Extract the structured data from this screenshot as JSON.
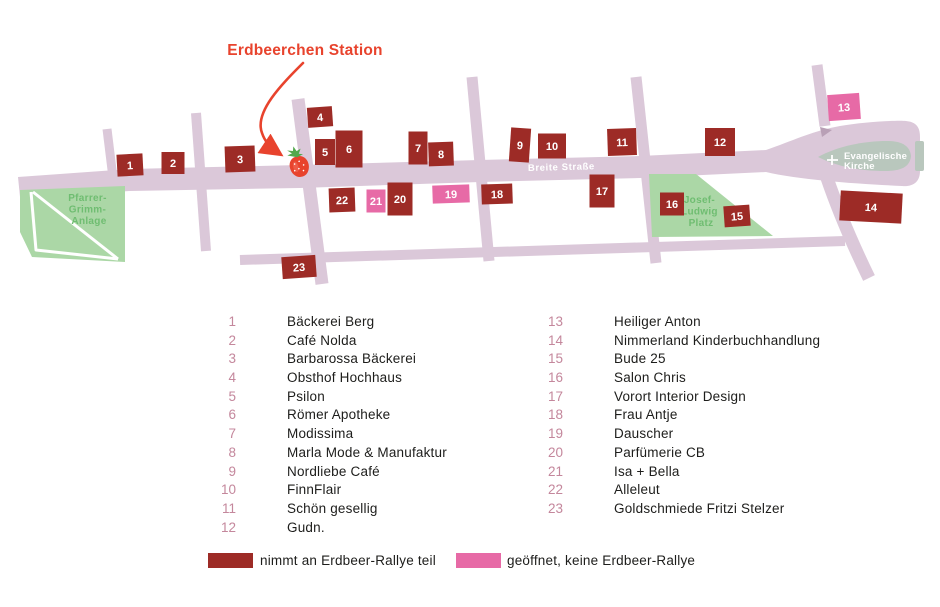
{
  "title": {
    "label": "Erdbeerchen Station"
  },
  "map": {
    "street_label": "Breite Straße",
    "areas": {
      "park": {
        "name": "Pfarrer-Grimm-Anlage",
        "lines": [
          "Pfarrer-",
          "Grimm-",
          "Anlage"
        ]
      },
      "platz": {
        "name": "Josef-Ludwig-Platz",
        "lines": [
          "Josef-",
          "Ludwig",
          "Platz"
        ]
      },
      "church": {
        "name": "Evangelische Kirche",
        "lines": [
          "Evangelische",
          "Kirche"
        ]
      }
    },
    "station_icon": "strawberry-icon",
    "markers": [
      {
        "n": 1,
        "type": "rallye",
        "x": 130,
        "y": 165,
        "w": 26,
        "h": 22,
        "rot": -3
      },
      {
        "n": 2,
        "type": "rallye",
        "x": 173,
        "y": 163,
        "w": 23,
        "h": 22,
        "rot": 0
      },
      {
        "n": 3,
        "type": "rallye",
        "x": 240,
        "y": 159,
        "w": 30,
        "h": 26,
        "rot": -2
      },
      {
        "n": 4,
        "type": "rallye",
        "x": 320,
        "y": 117,
        "w": 25,
        "h": 20,
        "rot": -4
      },
      {
        "n": 5,
        "type": "rallye",
        "x": 325,
        "y": 152,
        "w": 20,
        "h": 26,
        "rot": 0
      },
      {
        "n": 6,
        "type": "rallye",
        "x": 349,
        "y": 149,
        "w": 27,
        "h": 37,
        "rot": 0
      },
      {
        "n": 7,
        "type": "rallye",
        "x": 418,
        "y": 148,
        "w": 19,
        "h": 33,
        "rot": 0
      },
      {
        "n": 8,
        "type": "rallye",
        "x": 441,
        "y": 154,
        "w": 25,
        "h": 24,
        "rot": -2
      },
      {
        "n": 9,
        "type": "rallye",
        "x": 520,
        "y": 145,
        "w": 20,
        "h": 34,
        "rot": 4
      },
      {
        "n": 10,
        "type": "rallye",
        "x": 552,
        "y": 146,
        "w": 28,
        "h": 25,
        "rot": 0
      },
      {
        "n": 11,
        "type": "rallye",
        "x": 622,
        "y": 142,
        "w": 29,
        "h": 27,
        "rot": -2
      },
      {
        "n": 12,
        "type": "rallye",
        "x": 720,
        "y": 142,
        "w": 30,
        "h": 28,
        "rot": 0
      },
      {
        "n": 13,
        "type": "open",
        "x": 844,
        "y": 107,
        "w": 32,
        "h": 26,
        "rot": -4
      },
      {
        "n": 14,
        "type": "rallye",
        "x": 871,
        "y": 207,
        "w": 62,
        "h": 30,
        "rot": 3
      },
      {
        "n": 15,
        "type": "rallye",
        "x": 737,
        "y": 216,
        "w": 26,
        "h": 21,
        "rot": -4
      },
      {
        "n": 16,
        "type": "rallye",
        "x": 672,
        "y": 204,
        "w": 24,
        "h": 23,
        "rot": 0
      },
      {
        "n": 17,
        "type": "rallye",
        "x": 602,
        "y": 191,
        "w": 25,
        "h": 33,
        "rot": 0
      },
      {
        "n": 18,
        "type": "rallye",
        "x": 497,
        "y": 194,
        "w": 31,
        "h": 20,
        "rot": -2
      },
      {
        "n": 19,
        "type": "open",
        "x": 451,
        "y": 194,
        "w": 37,
        "h": 18,
        "rot": -2
      },
      {
        "n": 20,
        "type": "rallye",
        "x": 400,
        "y": 199,
        "w": 25,
        "h": 33,
        "rot": 0
      },
      {
        "n": 21,
        "type": "open",
        "x": 376,
        "y": 201,
        "w": 19,
        "h": 23,
        "rot": 0
      },
      {
        "n": 22,
        "type": "rallye",
        "x": 342,
        "y": 200,
        "w": 26,
        "h": 24,
        "rot": -2
      },
      {
        "n": 23,
        "type": "rallye",
        "x": 299,
        "y": 267,
        "w": 34,
        "h": 22,
        "rot": -4
      }
    ]
  },
  "directory": {
    "left": [
      {
        "n": "1",
        "name": "Bäckerei Berg"
      },
      {
        "n": "2",
        "name": "Café Nolda"
      },
      {
        "n": "3",
        "name": "Barbarossa Bäckerei"
      },
      {
        "n": "4",
        "name": "Obsthof Hochhaus"
      },
      {
        "n": "5",
        "name": "Psilon"
      },
      {
        "n": "6",
        "name": "Römer Apotheke"
      },
      {
        "n": "7",
        "name": "Modissima"
      },
      {
        "n": "8",
        "name": "Marla Mode & Manufaktur"
      },
      {
        "n": "9",
        "name": "Nordliebe Café"
      },
      {
        "n": "10",
        "name": "FinnFlair"
      },
      {
        "n": "11",
        "name": "Schön gesellig"
      },
      {
        "n": "12",
        "name": "Gudn."
      }
    ],
    "right": [
      {
        "n": "13",
        "name": "Heiliger Anton"
      },
      {
        "n": "14",
        "name": "Nimmerland Kinderbuchhandlung"
      },
      {
        "n": "15",
        "name": "Bude 25"
      },
      {
        "n": "16",
        "name": "Salon Chris"
      },
      {
        "n": "17",
        "name": "Vorort Interior Design"
      },
      {
        "n": "18",
        "name": "Frau Antje"
      },
      {
        "n": "19",
        "name": "Dauscher"
      },
      {
        "n": "20",
        "name": "Parfümerie CB"
      },
      {
        "n": "21",
        "name": "Isa + Bella"
      },
      {
        "n": "22",
        "name": "Alleleut"
      },
      {
        "n": "23",
        "name": "Goldschmiede Fritzi Stelzer"
      }
    ]
  },
  "legend": {
    "rallye": {
      "label": "nimmt an Erdbeer-Rallye teil",
      "color": "#9d2b26"
    },
    "open": {
      "label": "geöffnet, keine Erdbeer-Rallye",
      "color": "#e76aa6"
    }
  },
  "colors": {
    "street": "#dbc8d9",
    "rallye": "#9d2b26",
    "open": "#e76aa6",
    "park_fill": "#abd7a6",
    "park_text": "#6fbd71",
    "church_fill": "#b9c7bd",
    "accent": "#e8432d",
    "legend_number": "#c4879c",
    "ink": "#1d1d1b"
  }
}
